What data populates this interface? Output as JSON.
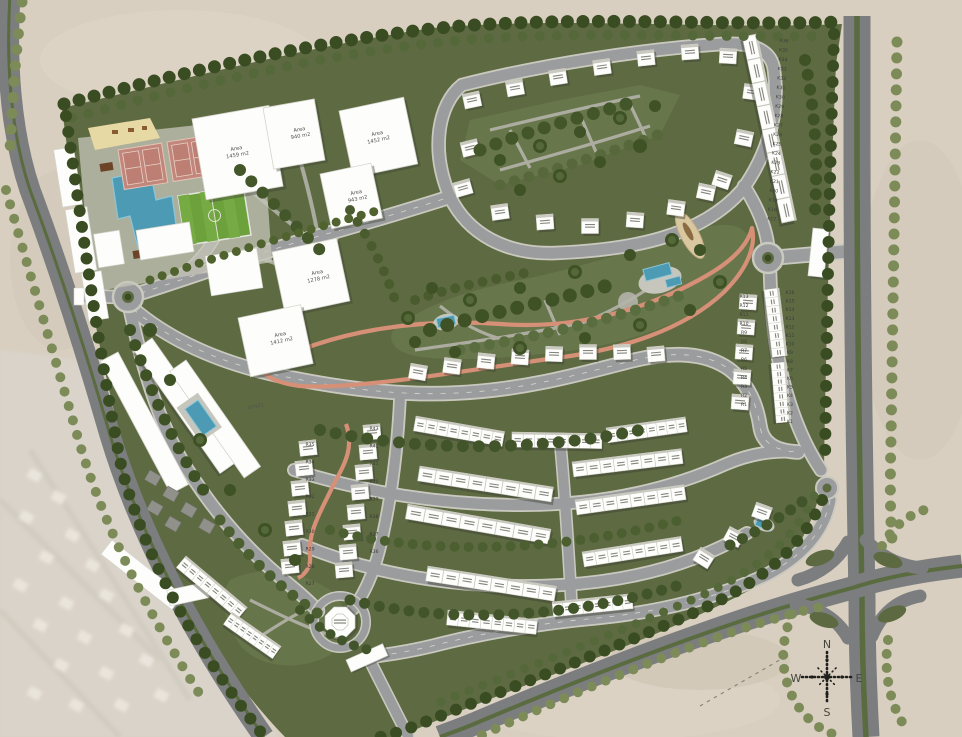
{
  "meta": {
    "type": "architectural-site-masterplan",
    "view": "aerial-rendered-plan"
  },
  "compass": {
    "north": "N",
    "east": "E",
    "south": "S",
    "west": "W"
  },
  "parcels": [
    {
      "line1": "Area",
      "line2": "1459 m2"
    },
    {
      "line1": "Area",
      "line2": "940 m2"
    },
    {
      "line1": "Area",
      "line2": "1452 m2"
    },
    {
      "line1": "Area",
      "line2": "943 m2"
    },
    {
      "line1": "Area",
      "line2": "1278 m2"
    },
    {
      "line1": "Area",
      "line2": "1412 m2"
    }
  ],
  "apartment": {
    "label": "AP401"
  },
  "units": {
    "k_outer": [
      "K36",
      "K35",
      "K34",
      "K33",
      "K32",
      "K31",
      "K30",
      "K29",
      "K28",
      "K27",
      "K26",
      "K25",
      "K24",
      "K23",
      "K22",
      "K21",
      "K20",
      "K19",
      "K18",
      "K17"
    ],
    "k_inner": [
      "K16",
      "K15",
      "K14",
      "K13",
      "K12",
      "K11",
      "K10",
      "K9",
      "K8",
      "K7",
      "K6",
      "K5",
      "K4",
      "K3",
      "K2",
      "K1"
    ],
    "r_east": [
      "R13",
      "R12",
      "R11",
      "R10",
      "R9",
      "R8",
      "R7",
      "R6",
      "R5",
      "R4",
      "R3",
      "R2",
      "R1"
    ],
    "r_west_east_col": [
      "R43",
      "R42",
      "R41",
      "R40",
      "R39",
      "R38",
      "R37",
      "R36"
    ],
    "r_west_west_col": [
      "R35",
      "R34",
      "R33",
      "R32",
      "R31",
      "R30",
      "R29",
      "R28",
      "R27"
    ]
  },
  "amenities": [
    "swimming-pool",
    "tennis-courts",
    "football-pitch",
    "kids-play-area",
    "central-park",
    "jogging-track",
    "mosque",
    "east-gate",
    "south-gate",
    "roundabouts",
    "highway-interchange"
  ],
  "colors": {
    "desert": "#d8cfc0",
    "site_green": "#5e6b42",
    "park_green": "#68764c",
    "tree_dark": "#3a4c22",
    "tree_mid": "#55683a",
    "tree_light": "#7d8b58",
    "road_major": "#7b7d7e",
    "road_minor": "#9b9c9d",
    "curb": "#cac9c0",
    "median_green": "#5a6b3f",
    "building_white": "#fdfdfb",
    "pool_blue": "#4d9ab4",
    "tennis_pink": "#c2867c",
    "pitch_green": "#6da13c",
    "sand_yellow": "#e7d9a4",
    "track_pink": "#d69078"
  }
}
